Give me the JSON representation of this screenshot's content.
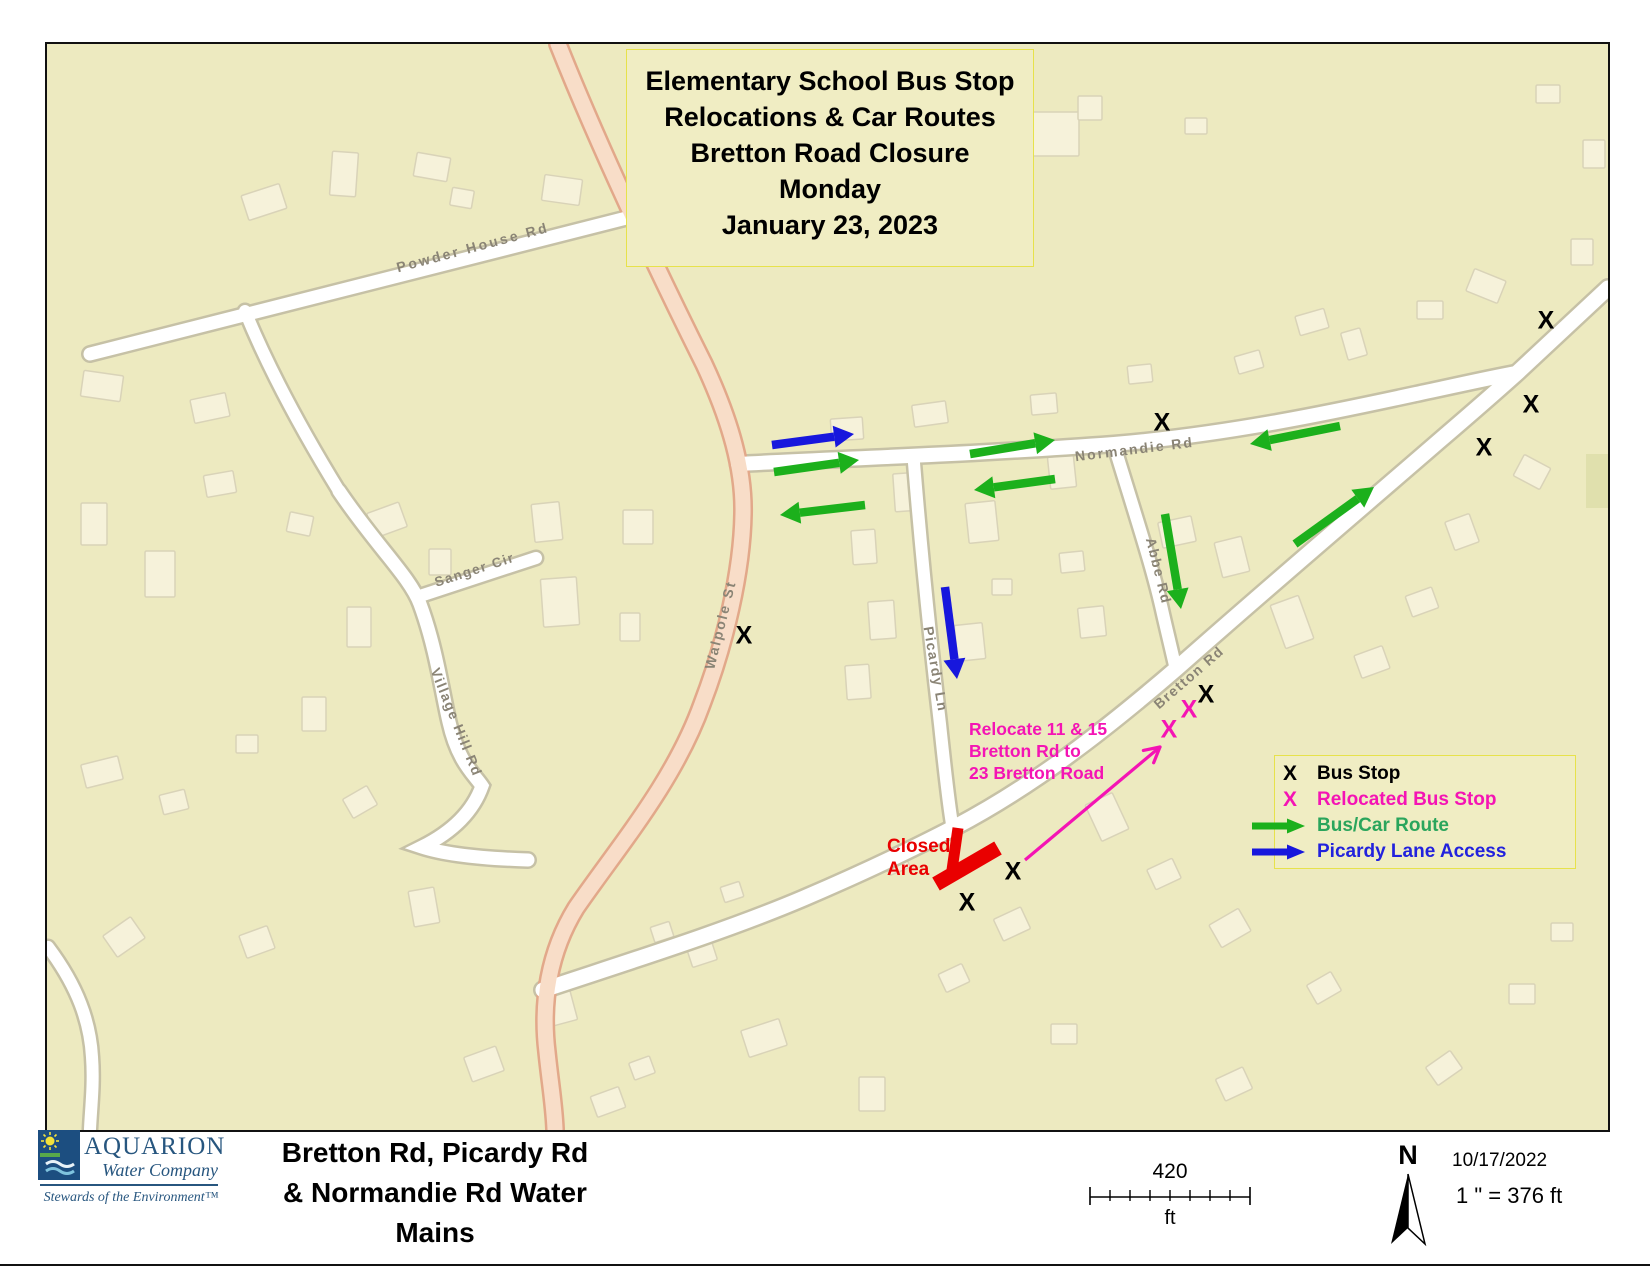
{
  "colors": {
    "map_bg": "#edeac0",
    "box_bg": "#f0edc3",
    "box_border": "#e7e24b",
    "house_fill": "#f6f2da",
    "house_edge": "#d9d3b8",
    "road_fill": "#ffffff",
    "road_casing": "#c6c1a6",
    "walpole_fill": "#f8ddc8",
    "walpole_casing": "#e2a88a",
    "road_label": "#8a8475",
    "green_arrow": "#1cb01c",
    "blue_arrow": "#1717dd",
    "magenta": "#f414b4",
    "red": "#e90000",
    "legend_green_text": "#2aa55c",
    "legend_blue_text": "#2222dd",
    "aquarion_blue": "#27567f"
  },
  "map": {
    "title_box": {
      "lines": [
        "Elementary School Bus Stop",
        "Relocations & Car Routes",
        "Bretton Road Closure",
        "Monday",
        "January 23, 2023"
      ]
    },
    "roads": [
      {
        "id": "powder-house-rd",
        "label": "Powder House Rd",
        "path": "M 88,352 L 664,206",
        "w": 13,
        "type": "white",
        "lx": 472,
        "ly": 250,
        "angle": -15,
        "ls": 2.5,
        "fs": 14
      },
      {
        "id": "north-branch",
        "label": "",
        "path": "M 243,309 C 272,380 310,445 337,489",
        "w": 12,
        "type": "white"
      },
      {
        "id": "village-hill-rd",
        "label": "Village Hill Rd",
        "path": "M 337,489 C 375,545 408,575 418,602 C 434,645 440,690 447,720 C 456,760 472,772 480,784 C 468,818 438,836 420,845 C 448,854 494,857 526,858",
        "w": 13,
        "type": "white",
        "lx": 450,
        "ly": 722,
        "angle": 68,
        "ls": 1.5,
        "fs": 14
      },
      {
        "id": "sanger-cir",
        "label": "Sanger Cir",
        "path": "M 418,594 L 534,556",
        "w": 12,
        "type": "white",
        "lx": 474,
        "ly": 572,
        "angle": -18,
        "ls": 1.5,
        "fs": 13.5
      },
      {
        "id": "bottom-left-rd",
        "label": "",
        "path": "M 46,945 C 76,985 88,1020 90,1055 C 92,1082 89,1105 88,1127",
        "w": 12,
        "type": "white"
      },
      {
        "id": "normandie-rd",
        "label": "Normandie Rd",
        "path": "M 736,462 C 850,456 980,452 1112,442 C 1230,432 1340,408 1414,392 C 1452,384 1482,377 1514,371",
        "w": 14,
        "type": "white",
        "lx": 1133,
        "ly": 452,
        "angle": -7,
        "ls": 2,
        "fs": 14
      },
      {
        "id": "picardy-ln",
        "label": "Picardy Ln",
        "path": "M 912,461 C 920,560 929,645 938,722 C 943,770 947,806 951,828",
        "w": 12,
        "type": "white",
        "lx": 929,
        "ly": 668,
        "angle": 80,
        "ls": 1.5,
        "fs": 14
      },
      {
        "id": "abbe-rd",
        "label": "Abbe Rd",
        "path": "M 1112,443 C 1133,512 1151,566 1161,612 C 1167,638 1171,654 1174,668",
        "w": 12,
        "type": "white",
        "lx": 1152,
        "ly": 570,
        "angle": 76,
        "ls": 1.5,
        "fs": 14
      },
      {
        "id": "bretton-rd",
        "label": "Bretton Rd",
        "path": "M 541,988 C 625,960 722,930 802,896 C 872,866 916,844 953,825 C 1031,784 1102,729 1174,667 C 1262,589 1362,504 1437,439 C 1472,409 1496,388 1516,370 L 1606,286",
        "w": 15,
        "type": "white",
        "lx": 1190,
        "ly": 679,
        "angle": -41,
        "ls": 1.5,
        "fs": 14
      },
      {
        "id": "walpole-st",
        "label": "Walpole St",
        "path": "M 556,42 C 595,140 652,262 702,362 C 729,420 742,468 741,512 C 740,570 723,642 700,702 C 672,780 616,845 574,906 C 547,950 539,1000 545,1050 C 548,1080 552,1102 553,1127",
        "w": 15,
        "type": "salmon",
        "lx": 723,
        "ly": 624,
        "angle": -76,
        "ls": 2,
        "fs": 14
      }
    ],
    "bus_stops": [
      [
        1544,
        318
      ],
      [
        1529,
        402
      ],
      [
        1482,
        445
      ],
      [
        1160,
        420
      ],
      [
        742,
        633
      ],
      [
        1204,
        692
      ],
      [
        1011,
        869
      ],
      [
        965,
        900
      ]
    ],
    "relocated_stops": [
      [
        1187,
        707
      ],
      [
        1167,
        727
      ]
    ],
    "green_arrows": [
      [
        772,
        470,
        857,
        458
      ],
      [
        968,
        452,
        1053,
        438
      ],
      [
        1053,
        477,
        972,
        488
      ],
      [
        863,
        503,
        778,
        513
      ],
      [
        1338,
        424,
        1248,
        442
      ],
      [
        1163,
        512,
        1179,
        607
      ],
      [
        1293,
        542,
        1372,
        485
      ]
    ],
    "blue_arrows": [
      [
        770,
        443,
        852,
        432
      ],
      [
        943,
        585,
        955,
        677
      ]
    ],
    "relocation_arrow": [
      1023,
      858,
      1158,
      745
    ],
    "closure_bars": [
      [
        956,
        826,
        950,
        868,
        11
      ],
      [
        934,
        882,
        996,
        846,
        15
      ]
    ],
    "closed_area_label": {
      "lines": [
        "Closed",
        "Area"
      ]
    },
    "relocate_note": {
      "lines": [
        "Relocate 11 & 15",
        "Bretton Rd to",
        "23 Bretton Road"
      ]
    },
    "legend": {
      "items": [
        {
          "symbol": "X",
          "label": "Bus Stop"
        },
        {
          "symbol": "X",
          "label": "Relocated Bus Stop"
        },
        {
          "symbol": "arrow",
          "label": "Bus/Car Route"
        },
        {
          "symbol": "arrow",
          "label": "Picardy Lane Access"
        }
      ]
    }
  },
  "footer": {
    "logo": {
      "name": "AQUARION",
      "subtitle": "Water Company",
      "tagline": "Stewards of the Environment™"
    },
    "title_lines": [
      "Bretton Rd, Picardy Rd",
      "& Normandie Rd Water",
      "Mains"
    ],
    "scale_value": "420",
    "scale_unit": "ft",
    "north_label": "N",
    "date": "10/17/2022",
    "scale_ratio": "1 \" = 376 ft"
  }
}
